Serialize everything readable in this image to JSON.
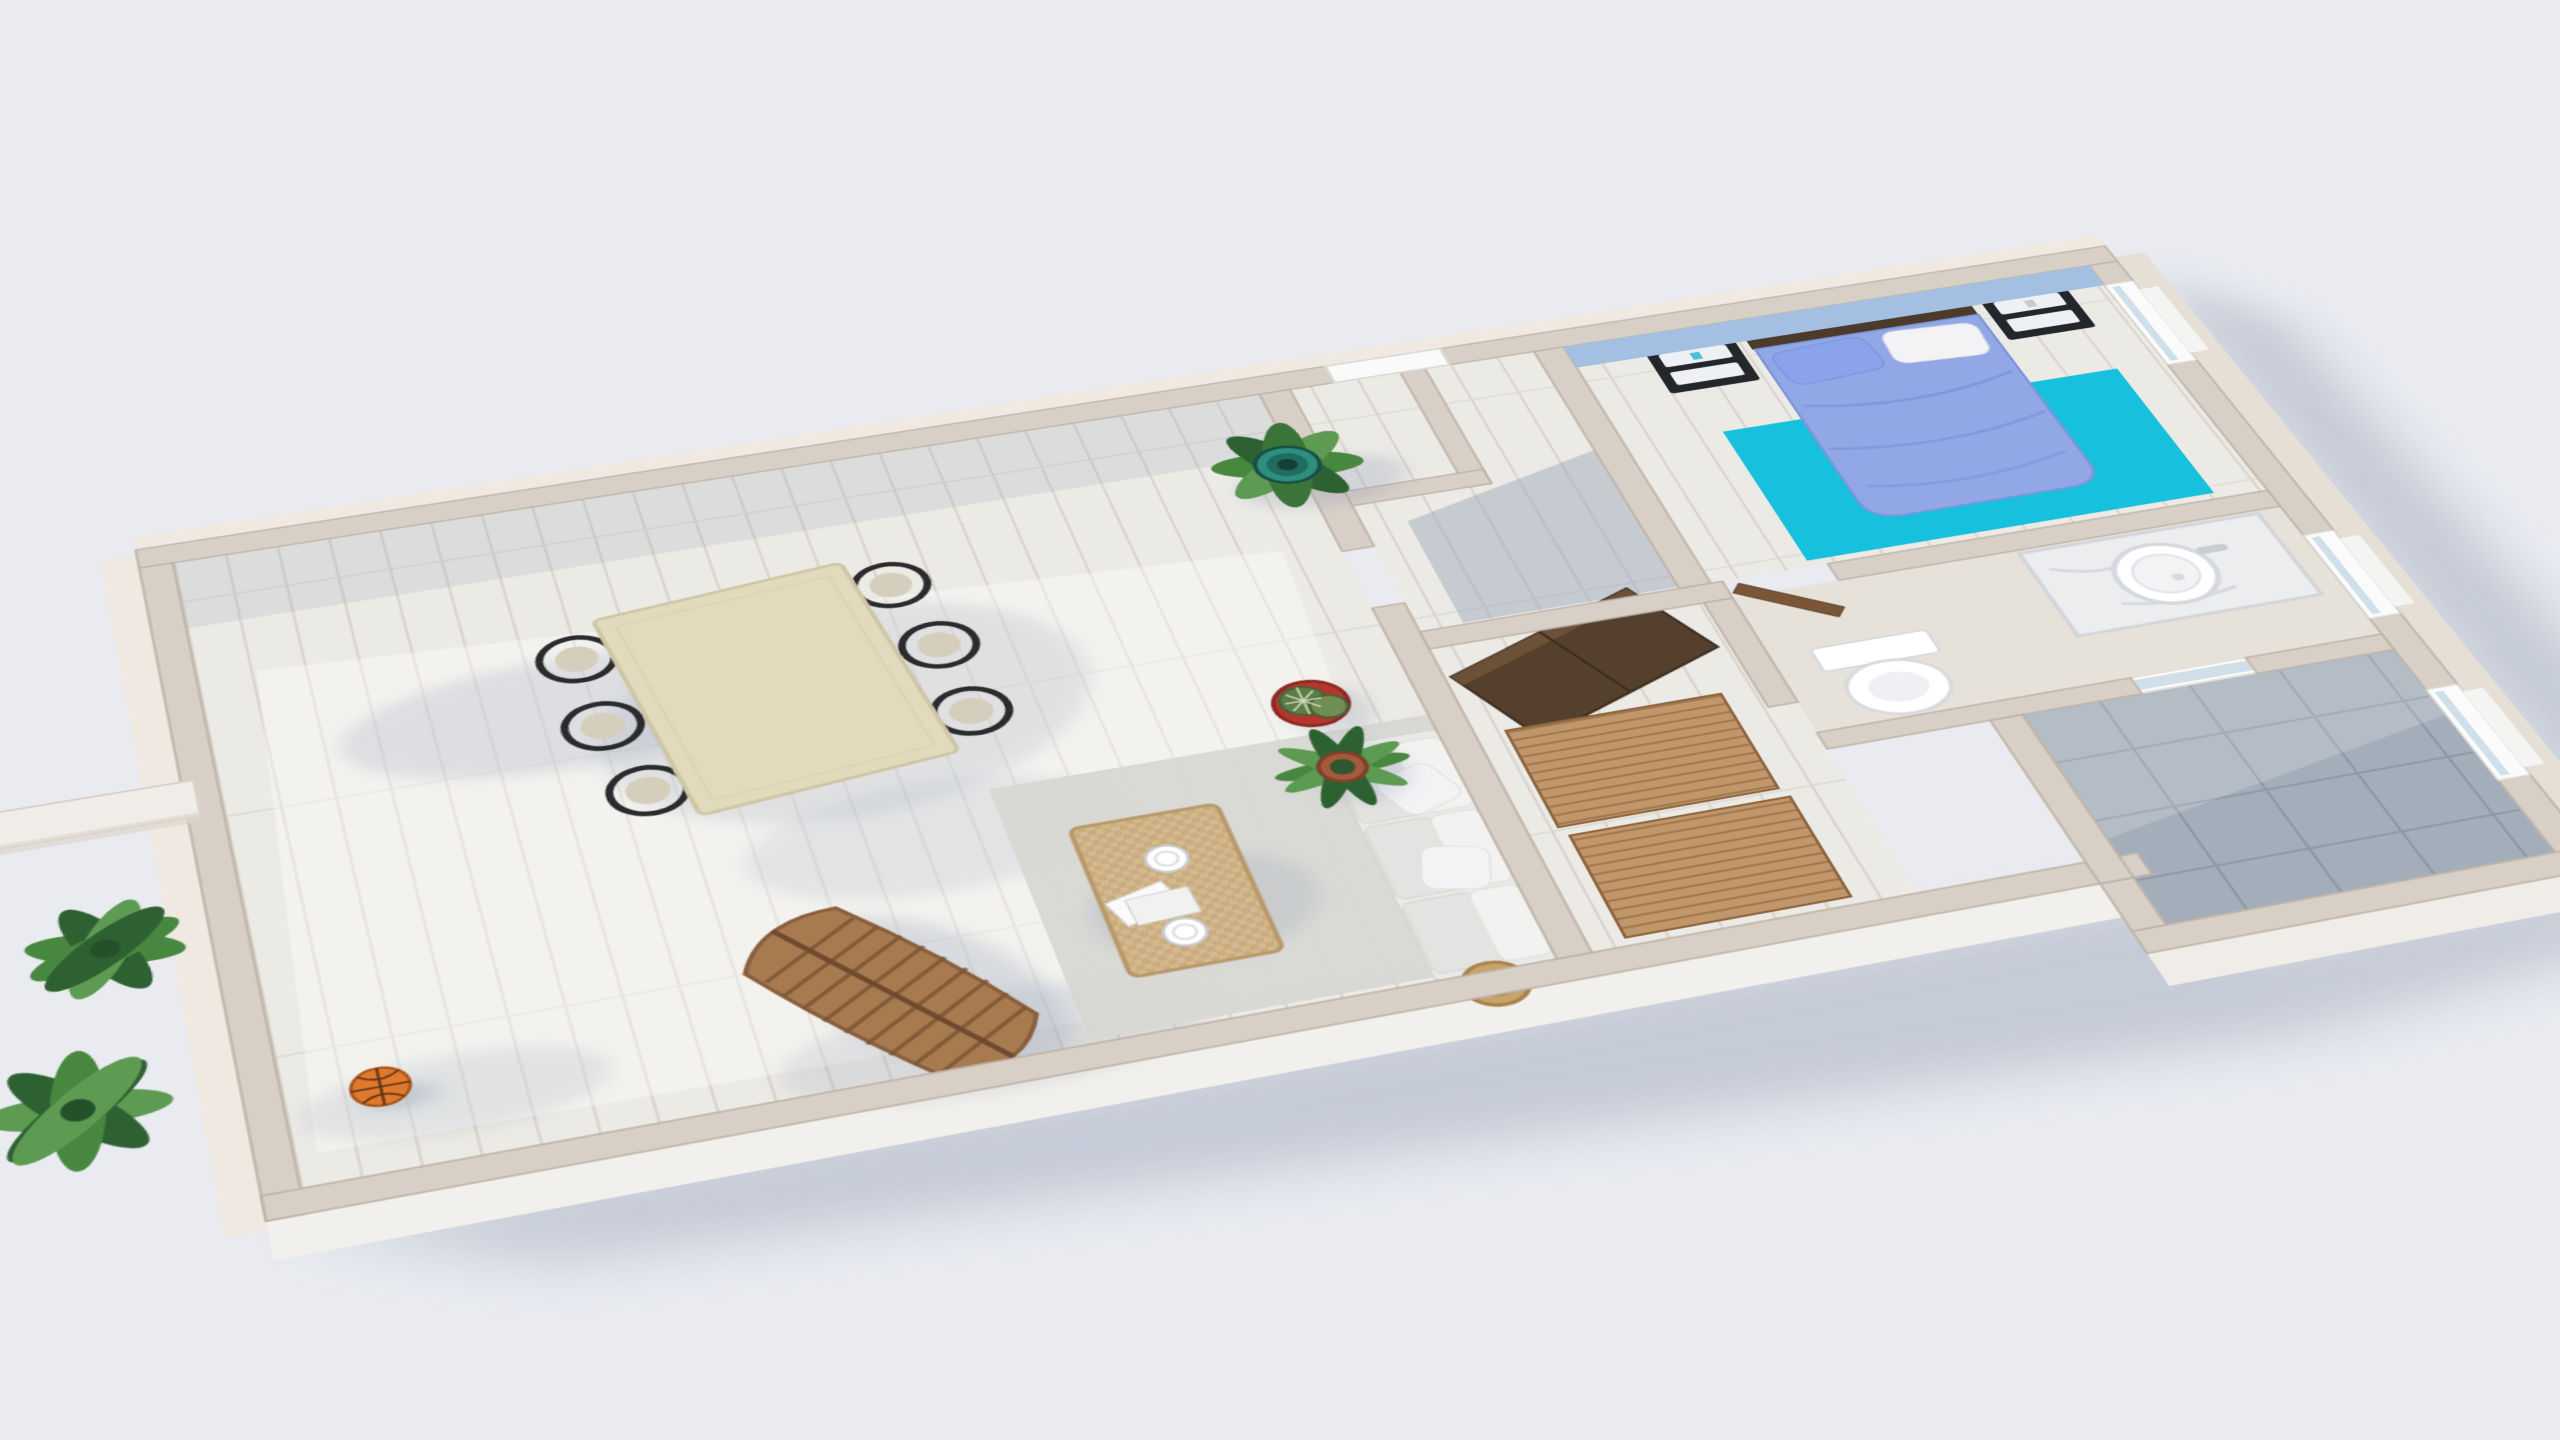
{
  "scene": {
    "type": "3d-floor-plan-render",
    "view": "elevated three-quarter top-down perspective, plan rotated clockwise",
    "background": "plain light gray studio backdrop with soft cast shadow to lower-right",
    "rooms": [
      {
        "name": "living-dining-room",
        "floor": "whitewashed wood planks",
        "features": [
          "dining set",
          "sofa",
          "coffee table",
          "lounge chair",
          "basketball",
          "potted plants"
        ]
      },
      {
        "name": "entry-hall",
        "floor": "whitewashed wood planks",
        "features": [
          "white entrance door",
          "L-shaped partition",
          "shadowed nook"
        ]
      },
      {
        "name": "bedroom",
        "accent_wall_color": "light blue",
        "features": [
          "double bed",
          "two nightstands",
          "turquoise rug",
          "east window"
        ]
      },
      {
        "name": "closet-corridor",
        "features": [
          "dark wood wardrobe",
          "two wood slat runners",
          "bedroom door ajar"
        ]
      },
      {
        "name": "bathroom",
        "features": [
          "marble vanity with round vessel sink",
          "toilet",
          "east window"
        ]
      },
      {
        "name": "shower-room",
        "floor": "gray tile",
        "features": [
          "glass partition",
          "east window"
        ]
      }
    ],
    "furniture": [
      {
        "name": "dining-table",
        "color_key": "tableCream",
        "shape": "rectangular",
        "seats": 6
      },
      {
        "name": "dining-chairs",
        "count": 6,
        "style": "black wishbone",
        "color_key": "chairBlack"
      },
      {
        "name": "sofa",
        "seats": 3,
        "color_key": "sofa",
        "throw_pillows": 2,
        "basket": "woven, at foot"
      },
      {
        "name": "coffee-table",
        "material": "woven rattan",
        "items_on_top": [
          "two white plates",
          "papers"
        ]
      },
      {
        "name": "area-rug-living",
        "color_key": "rugGray"
      },
      {
        "name": "lounge-chair",
        "material": "slatted bent wood",
        "color_key": "lounge"
      },
      {
        "name": "bed",
        "duvet_color_key": "duvet",
        "pillows": [
          "blue",
          "white"
        ]
      },
      {
        "name": "headboard",
        "color_key": "headboard"
      },
      {
        "name": "nightstands",
        "count": 2,
        "color_key": "nightstand",
        "drawer_color_key": "drawer"
      },
      {
        "name": "bedroom-rug",
        "color_key": "rugCyan"
      },
      {
        "name": "wardrobe",
        "color_key": "wardrobe",
        "placement": "angled at corridor head"
      },
      {
        "name": "slat-runners",
        "count": 2,
        "color_key": "slat"
      },
      {
        "name": "vanity",
        "top": "marble",
        "sink": "round white vessel"
      },
      {
        "name": "toilet",
        "color": "white"
      },
      {
        "name": "basketball",
        "color_key": "basketball"
      }
    ],
    "plants": [
      {
        "name": "broadleaf-plant-teal-pot",
        "pot": "teal striped",
        "location": "corner of entry wall"
      },
      {
        "name": "barrel-cactus",
        "pot": "red",
        "location": "against corridor wall"
      },
      {
        "name": "agave-plant",
        "pot": "terracotta",
        "location": "against corridor wall"
      },
      {
        "name": "exterior-plant-upper",
        "location": "outside west wall"
      },
      {
        "name": "exterior-plant-lower",
        "location": "outside west wall"
      }
    ],
    "colors": {
      "bg": "#e9ebf0",
      "wallTop": "#d8cfc6",
      "wallFace": "#efe9e2",
      "wallEdge": "#bdb2a6",
      "floor": "#eceae5",
      "floorLine": "#dbd7d0",
      "blueWall": "#a3c0e2",
      "rugCyan": "#17c0dd",
      "duvet": "#92a7e6",
      "duvetFold": "#7b93d8",
      "pillowWhite": "#f3f3f6",
      "headboard": "#4c3a2a",
      "nightstand": "#23262b",
      "drawer": "#eef0f3",
      "tableCream": "#e1dabc",
      "chairBlack": "#2b2b2e",
      "chairSeat": "#d6cebc",
      "sofa": "#e9e9e7",
      "cushion": "#f2f2f0",
      "rattan": "#d4b98e",
      "rugGray": "#d7d7d3",
      "lounge": "#a87a50",
      "loungeLine": "#7d5636",
      "wardrobe": "#55402d",
      "slat": "#c0966a",
      "slatLine": "#a3784e",
      "potRed": "#b4372e",
      "terracotta": "#a65a3c",
      "cactus": "#5c7d46",
      "leaf": "#47873f",
      "leafDark": "#2e6132",
      "basketball": "#e0792c",
      "tile": "#a4aeba",
      "tileLine": "#8f9aa9",
      "marble": "#ecedee",
      "glass": "#cfe0ea",
      "doorWood": "#7a5636",
      "shadow": "#9aa4b8",
      "white": "#ffffff"
    }
  }
}
